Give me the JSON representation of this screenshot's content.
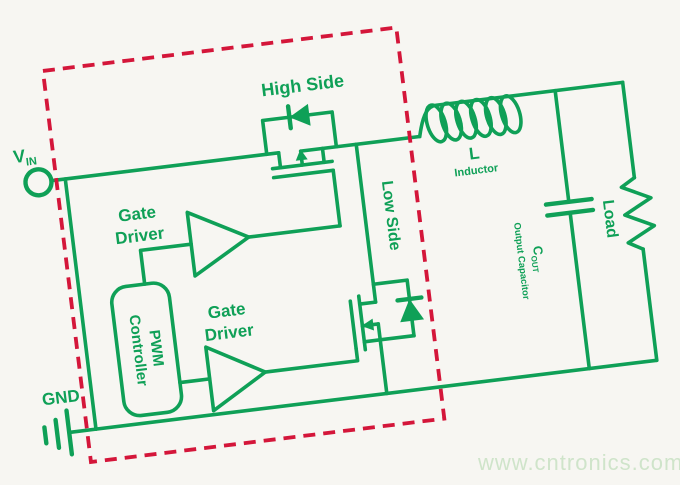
{
  "colors": {
    "circuit_green": "#0fa057",
    "boundary_red": "#d4163a",
    "background": "#f7f6f2",
    "watermark_green": "#cfe4ca"
  },
  "diagram": {
    "type": "synchronous buck converter block diagram",
    "labels": {
      "vin_main": "V",
      "vin_sub": "IN",
      "gnd": "GND",
      "high_side": "High Side",
      "low_side": "Low Side",
      "gate_driver_top_line1": "Gate",
      "gate_driver_top_line2": "Driver",
      "gate_driver_bottom_line1": "Gate",
      "gate_driver_bottom_line2": "Driver",
      "pwm_line1": "PWM",
      "pwm_line2": "Controller",
      "inductor_ref": "L",
      "inductor_name": "Inductor",
      "cap_ref_main": "C",
      "cap_ref_sub": "OUT",
      "cap_name": "Output Capacitor",
      "load": "Load",
      "watermark": "www.cntronics.com"
    }
  }
}
